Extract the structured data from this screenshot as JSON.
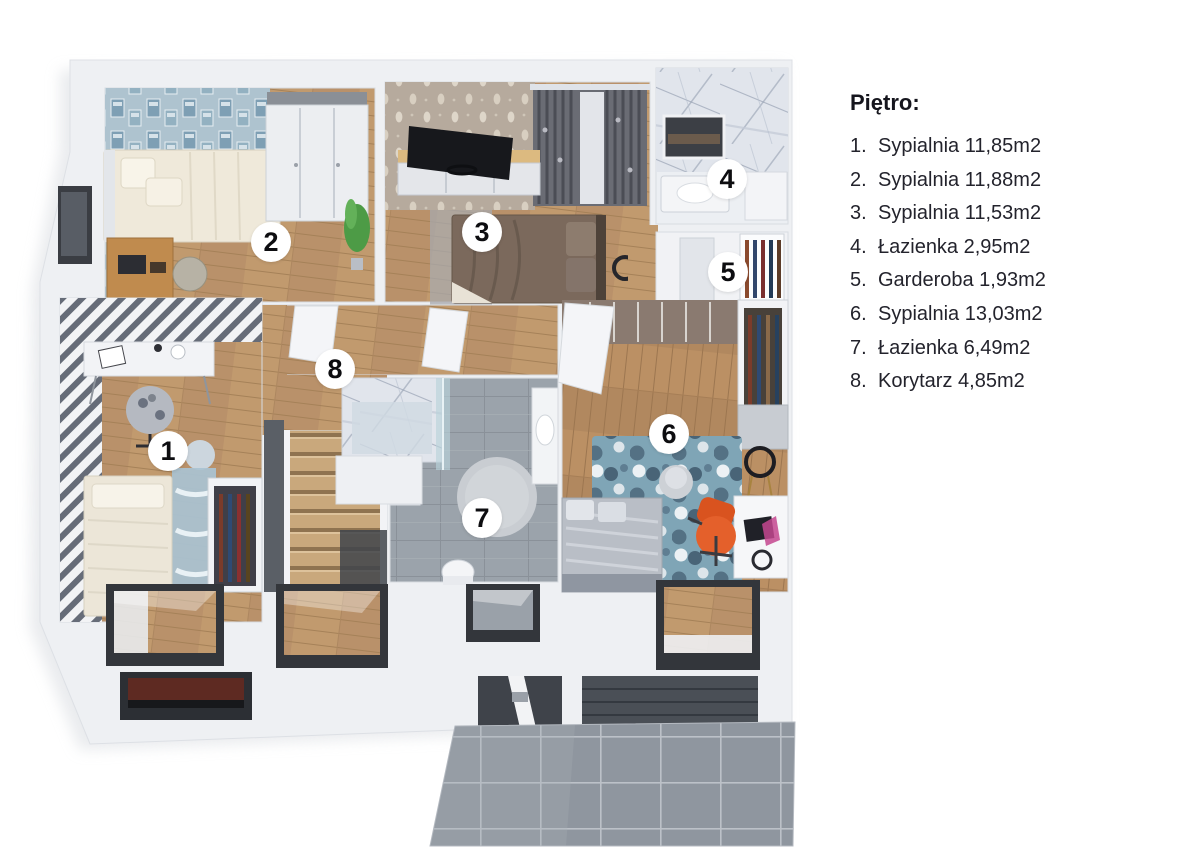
{
  "legend": {
    "title": "Piętro:",
    "items": [
      {
        "num": "1.",
        "text": "Sypialnia 11,85m2"
      },
      {
        "num": "2.",
        "text": "Sypialnia 11,88m2"
      },
      {
        "num": "3.",
        "text": "Sypialnia 11,53m2"
      },
      {
        "num": "4.",
        "text": "Łazienka 2,95m2"
      },
      {
        "num": "5.",
        "text": "Garderoba 1,93m2"
      },
      {
        "num": "6.",
        "text": "Sypialnia 13,03m2"
      },
      {
        "num": "7.",
        "text": "Łazienka 6,49m2"
      },
      {
        "num": "8.",
        "text": "Korytarz 4,85m2"
      }
    ]
  },
  "markers": [
    {
      "number": "1",
      "room": "Sypialnia"
    },
    {
      "number": "2",
      "room": "Sypialnia"
    },
    {
      "number": "3",
      "room": "Sypialnia"
    },
    {
      "number": "4",
      "room": "Łazienka"
    },
    {
      "number": "5",
      "room": "Garderoba"
    },
    {
      "number": "6",
      "room": "Sypialnia"
    },
    {
      "number": "7",
      "room": "Łazienka"
    },
    {
      "number": "8",
      "room": "Korytarz"
    }
  ],
  "palette": {
    "wall_white": "#eef0f3",
    "wood_floor": "#c19a6e",
    "blue_wallpaper": "#a6c0ce",
    "beige_wallpaper": "#b5a99c",
    "stripe_wallpaper": "#646a76",
    "marble": "#e1e5ec",
    "bath_tile": "#9ba3ab",
    "terrace_tile": "#8f969f",
    "accent_chair": "#e4602b",
    "stairs_wood": "#c9a87c"
  }
}
